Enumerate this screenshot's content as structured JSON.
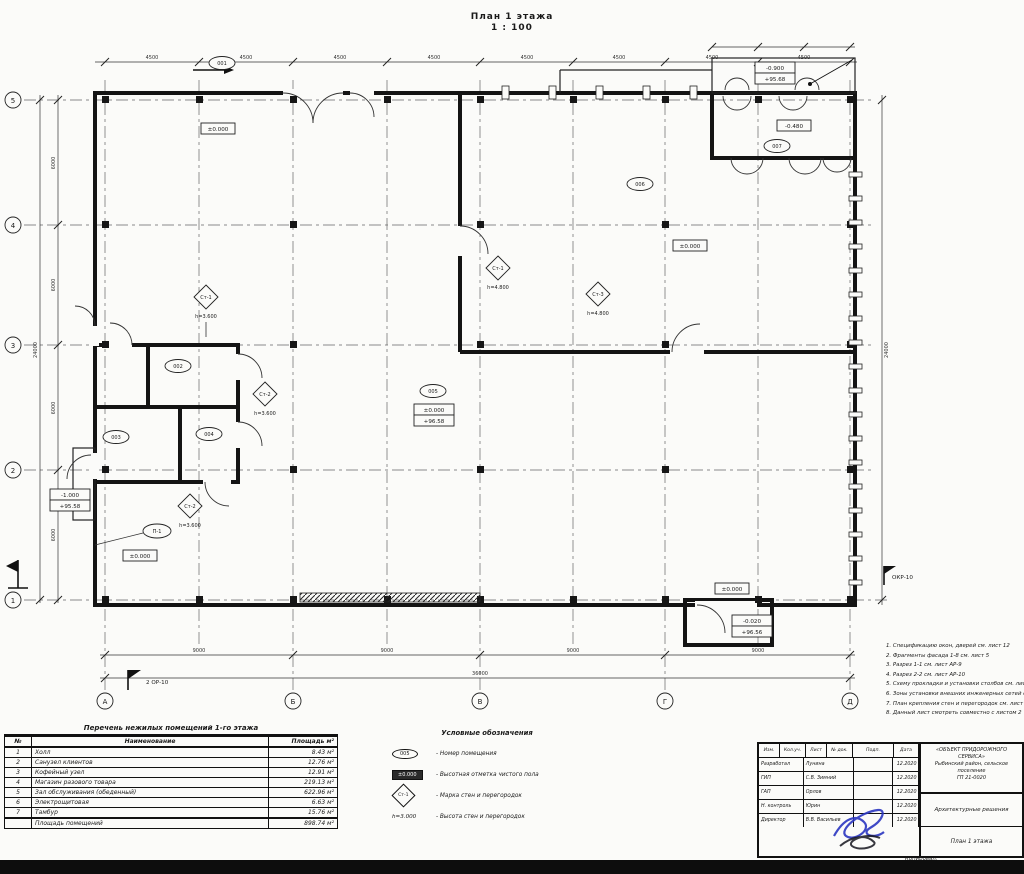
{
  "title": {
    "line1": "План 1 этажа",
    "line2": "1 : 100"
  },
  "axes": {
    "rows": [
      "5",
      "4",
      "3",
      "2",
      "1"
    ],
    "cols": [
      "А",
      "Б",
      "В",
      "Г",
      "Д"
    ]
  },
  "dims": {
    "top_segments": [
      "4500",
      "4500",
      "4500",
      "4500",
      "4500",
      "4500",
      "4500",
      "4500"
    ],
    "left_segments": [
      "6000",
      "6000",
      "6000",
      "6000"
    ],
    "left_total": "24000",
    "bottom_segments": [
      "9000",
      "9000",
      "9000",
      "9000"
    ],
    "bottom_total": "36000",
    "right_total": "24000"
  },
  "plan": {
    "ovals": [
      "001",
      "002",
      "003",
      "004",
      "005",
      "006",
      "007"
    ],
    "panel_mark": "П-1",
    "wall_marks": [
      {
        "m": "Ст-1",
        "h": "h=3.600"
      },
      {
        "m": "Ст-2",
        "h": "h=3.600"
      },
      {
        "m": "Ст-1",
        "h": "h=4.800"
      },
      {
        "m": "Ст-3",
        "h": "h=4.800"
      },
      {
        "m": "Ст-2",
        "h": "h=3.600"
      }
    ],
    "elev": [
      "±0.000",
      "±0.000",
      "-0.480",
      "±0.000",
      "±0.000"
    ],
    "elev_stacked": [
      [
        "±0.000",
        "+96.58"
      ],
      [
        "-0.900",
        "+95.68"
      ],
      [
        "-0.020",
        "+96.56"
      ],
      [
        "-1.000",
        "+95.58"
      ]
    ],
    "section_flag_bottom": "2   ОР-10",
    "section_flag_right": "ОКР-10"
  },
  "legend": {
    "title": "Условные обозначения",
    "items": [
      {
        "sample": "005",
        "text": "- Номер помещения"
      },
      {
        "sample": "±0.000",
        "text": "- Высотная отметка чистого пола"
      },
      {
        "sample": "Ст-1",
        "text": "- Марка стен и перегородок"
      },
      {
        "sample": "h=3.000",
        "text": "- Высота стен и перегородок"
      }
    ]
  },
  "rooms_table": {
    "caption": "Перечень нежилых помещений 1-го этажа",
    "headers": {
      "num": "№",
      "name": "Наименование",
      "area": "Площадь м²"
    },
    "rows": [
      {
        "num": "1",
        "name": "Холл",
        "area": "8.43 м²"
      },
      {
        "num": "2",
        "name": "Санузел клиентов",
        "area": "12.76 м²"
      },
      {
        "num": "3",
        "name": "Кофейный узел",
        "area": "12.91 м²"
      },
      {
        "num": "4",
        "name": "Магазин разового товара",
        "area": "219.13 м²"
      },
      {
        "num": "5",
        "name": "Зал обслуживания (обеденный)",
        "area": "622.96 м²"
      },
      {
        "num": "6",
        "name": "Электрощитовая",
        "area": "6.63 м²"
      },
      {
        "num": "7",
        "name": "Тамбур",
        "area": "15.76 м²"
      }
    ],
    "total": {
      "label": "Площадь помещений",
      "area": "898.74 м²"
    }
  },
  "notes": {
    "items": [
      "1. Спецификацию окон, дверей см. лист 12",
      "2. Фрагменты фасада 1-8 см. лист 5",
      "3. Разрез 1-1 см. лист АР-9",
      "4. Разрез 2-2 см. лист АР-10",
      "5. Схему прокладки и установки столбов см. лист 14",
      "6. Зоны установки внешних инженерных сетей см. лист 15",
      "7. План крепления стен и перегородок см. лист 16",
      "8. Данный лист смотреть совместно с листом 2"
    ]
  },
  "title_block": {
    "header_cols": [
      "Изм.",
      "Кол.уч.",
      "Лист",
      "№ док.",
      "Подп.",
      "Дата"
    ],
    "rows": [
      {
        "role": "Разработал",
        "name": "Лунина",
        "date": "12.2020"
      },
      {
        "role": "ГИП",
        "name": "С.В. Зимний",
        "date": "12.2020"
      },
      {
        "role": "ГАП",
        "name": "Орлов",
        "date": "12.2020"
      },
      {
        "role": "Н. контроль",
        "name": "Юрин",
        "date": "12.2020"
      },
      {
        "role": "Директор",
        "name": "В.В. Васильев",
        "date": "12.2020"
      }
    ],
    "project_line1": "«ОБЪЕКТ ПРИДОРОЖНОГО СЕРВИСА»",
    "project_line2": "Рыбинский район, сельское поселение",
    "project_line3": "ГП 21-0020",
    "section": "Архитектурные решения",
    "sheet_name": "План 1 этажа",
    "footer": "Копировал:",
    "stamp_color": "#2a35c0"
  }
}
